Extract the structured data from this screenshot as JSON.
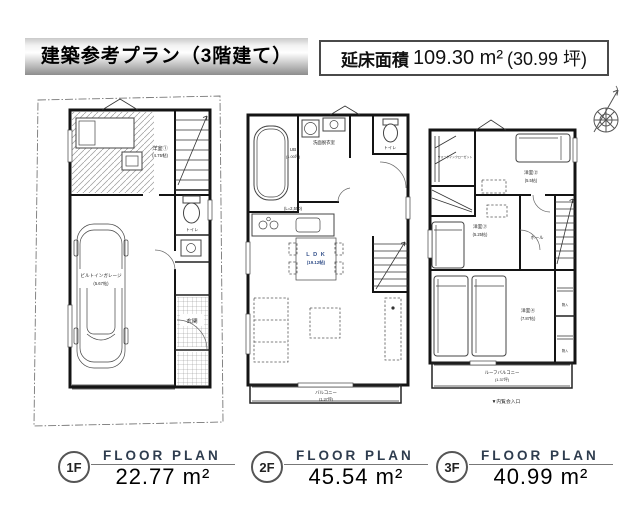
{
  "header": {
    "title": "建築参考プラン（3階建て）",
    "area_label": "延床面積",
    "area_value": "109.30 m²",
    "area_tsubo": "(30.99 坪)"
  },
  "floor_labels": [
    {
      "badge": "1F",
      "plan": "FLOOR PLAN",
      "area": "22.77 m²"
    },
    {
      "badge": "2F",
      "plan": "FLOOR PLAN",
      "area": "45.54 m²"
    },
    {
      "badge": "3F",
      "plan": "FLOOR PLAN",
      "area": "40.99 m²"
    }
  ],
  "plan_1f": {
    "room1": "洋室①",
    "room1_size": "(4.75帖)",
    "garage": "ビルトインガレージ",
    "garage_size": "(5.67帖)",
    "entrance": "玄関",
    "toilet": "トイレ"
  },
  "plan_2f": {
    "bath": "UB",
    "bath_size": "(1.00坪)",
    "washroom": "洗面脱衣室",
    "toilet": "トイレ",
    "kitchen_len": "(L=2,550)",
    "ldk": "L D K",
    "ldk_size": "(19.12帖)",
    "balcony": "バルコニー",
    "balcony_size": "(1.37坪)"
  },
  "plan_3f": {
    "wic": "ウォークインクローゼット",
    "room2": "洋室②",
    "room2_size": "(5.5帖)",
    "room3": "洋室③",
    "room3_size": "(5.25帖)",
    "room4": "洋室④",
    "room4_size": "(7.87帖)",
    "hall": "ホール",
    "storage": "物入",
    "roof_balcony": "ルーフバルコニー",
    "roof_balcony_size": "(1.37坪)",
    "entry_note": "▼内覧会入口"
  }
}
